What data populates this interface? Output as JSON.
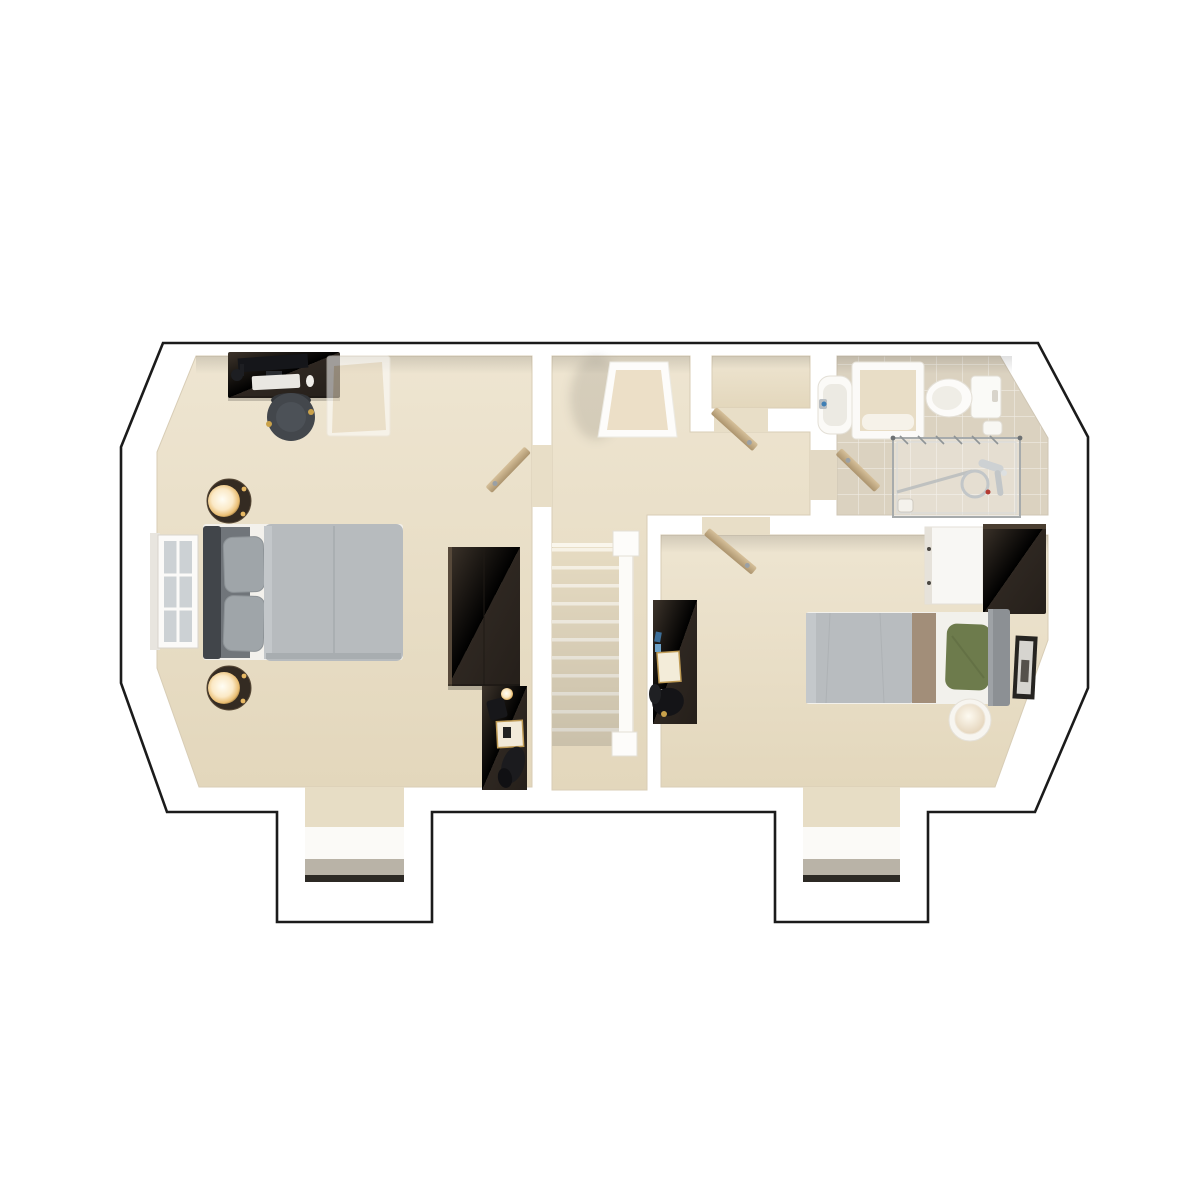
{
  "image_type": "3d-floorplan-render-top-view",
  "background": "#ffffff",
  "palette": {
    "outline": "#1b1b1b",
    "wall": "#ffffff",
    "carpet_light": "#eee5d1",
    "carpet_dark": "#e3d7bc",
    "bathroom_tile": "#dbd2c0",
    "dark_wood": "#362e26",
    "door_wood": "#c9b189",
    "duvet_gray": "#b8bcbf",
    "headboard_gray": "#41454a",
    "pillow_gray": "#9fa5a9",
    "pillow_green": "#6d7b4c",
    "blanket_tan": "#a28e79",
    "lamp_glow": "#fbe9c6",
    "brass": "#c9a24b",
    "chrome": "#b0b5b7",
    "sill_concrete": "#b9b3a7"
  },
  "floorplan": {
    "style": "photoreal 3d dollhouse top-down of an upper storey, white walls with black cut outline, two dormer window bays at the bottom, angled (chamfered) corner walls left and right",
    "rooms": [
      {
        "id": "bedroom-1",
        "furniture": [
          "desk-with-monitor-keyboard-lamp",
          "round-office-chair",
          "translucent-ghost-armchair",
          "double-bed-gray-duvet",
          "dark-headboard",
          "two-gray-pillows",
          "round-bedside-table-with-glowing-lamp-top",
          "round-bedside-table-with-glowing-lamp-bottom",
          "left-wall-window",
          "dark-wood-wardrobe",
          "dark-dresser-with-decor",
          "dormer-window-bay"
        ]
      },
      {
        "id": "landing-and-stairs",
        "furniture": [
          "built-in-storage-cupboard",
          "linen-closet",
          "open-cupboard-door",
          "carpeted-staircase",
          "white-balustrade-with-newel-posts",
          "open-bedroom1-door"
        ]
      },
      {
        "id": "bathroom",
        "fixtures": [
          "wash-basin-with-tap",
          "paneled-bathroom-unit",
          "toilet-with-cistern",
          "toilet-roll-holder",
          "glass-shower-enclosure",
          "chrome-shower-mixer",
          "shower-drain",
          "open-bathroom-door"
        ]
      },
      {
        "id": "bedroom-2",
        "furniture": [
          "single-bed-gray-duvet",
          "green-pillow",
          "tan-blanket-band",
          "gray-headboard",
          "white-chest-of-drawers",
          "dark-wood-wardrobe",
          "dark-desk-with-gold-frame",
          "black-desk-chair",
          "round-side-table-with-ball-lamp",
          "framed-picture-on-angled-wall",
          "open-bedroom2-door",
          "dormer-window-bay"
        ]
      }
    ],
    "doors_open_count": 4,
    "staircase": {
      "treads_visible": 11,
      "balustrade": "white with square newel posts"
    }
  }
}
